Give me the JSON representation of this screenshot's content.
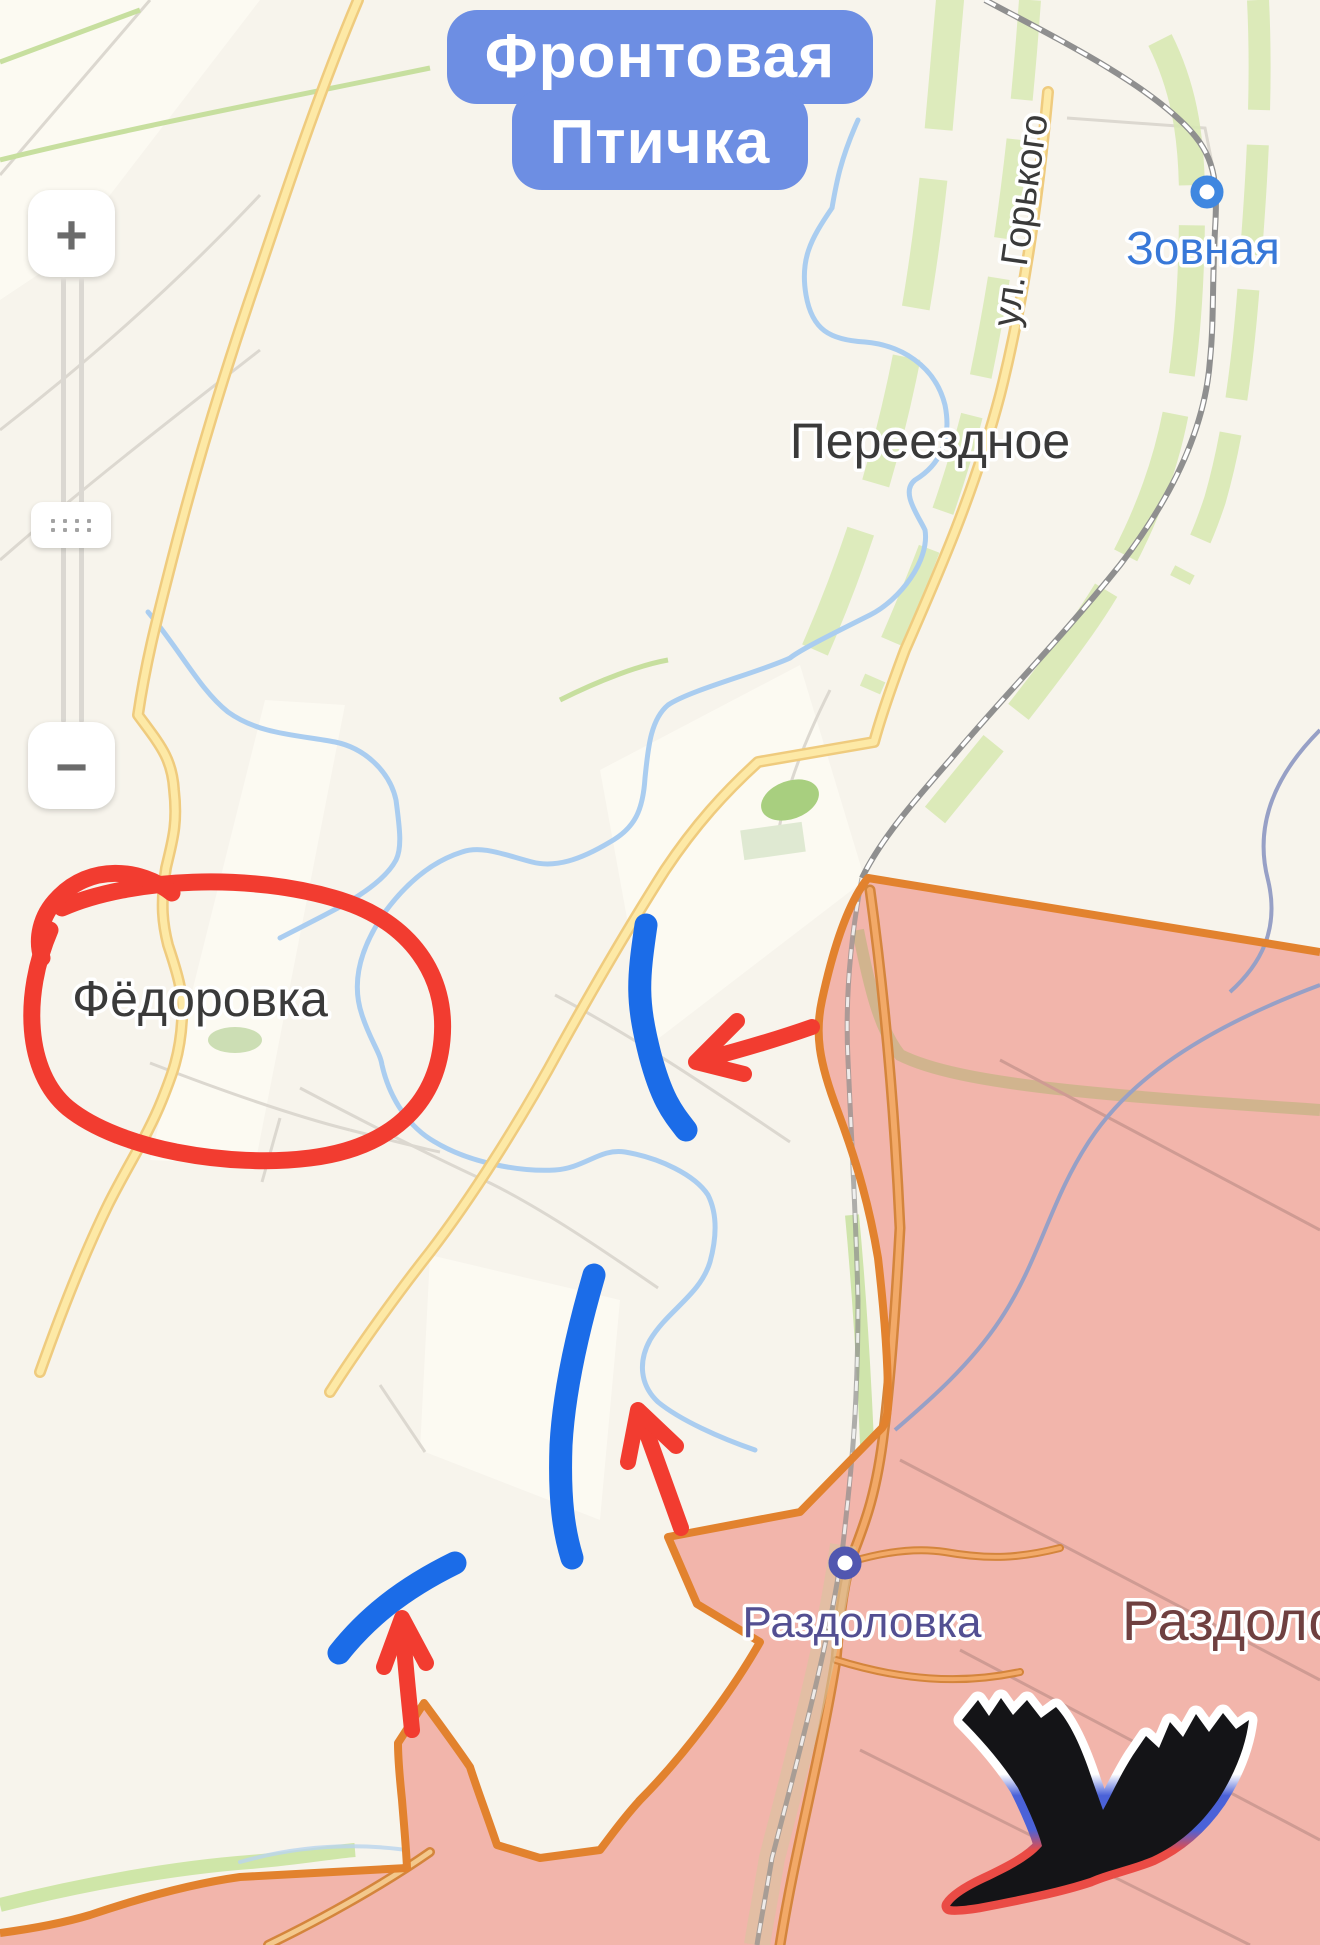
{
  "title": {
    "line1": "Фронтовая",
    "line2": "Птичка"
  },
  "zoom_control": {
    "zoom_in_label": "+",
    "zoom_out_label": "−"
  },
  "map_labels": {
    "zovnaya": "Зовная",
    "gorky_street": "ул. Горького",
    "pereezdnoe": "Переездное",
    "fedorovka": "Фёдоровка",
    "razdolovka": "Раздоловка",
    "razdolovka_large": "Раздоловка"
  },
  "annotations": {
    "red_circle": {
      "color": "#f23c30",
      "encircles": "Фёдоровка"
    },
    "blue_front_lines_count": 3,
    "red_arrows_count": 3,
    "bird_logo_colors": {
      "body": "#141417",
      "outline_top": "#ffffff",
      "outline_middle": "#4b62d8",
      "outline_bottom": "#ea4b45"
    }
  },
  "colors": {
    "badge_blue": "#6d8ee3",
    "badge_text": "#ffffff",
    "map_background": "#f7f4ec",
    "road_yellow": "#fde9a6",
    "road_yellow_casing": "#efcb7e",
    "river_blue": "#aacdf0",
    "railway_gray": "#8f8f8f",
    "green_vegetation": "#d8e9b4",
    "zone_fill": "#f2b5ab",
    "zone_border": "#e2822e",
    "annotation_blue": "#1b6ce8",
    "annotation_red": "#f23c30",
    "label_dark": "#3a3a3a",
    "label_blue": "#3878d8",
    "label_purple": "#534f92",
    "label_maroon": "#6f4040"
  }
}
